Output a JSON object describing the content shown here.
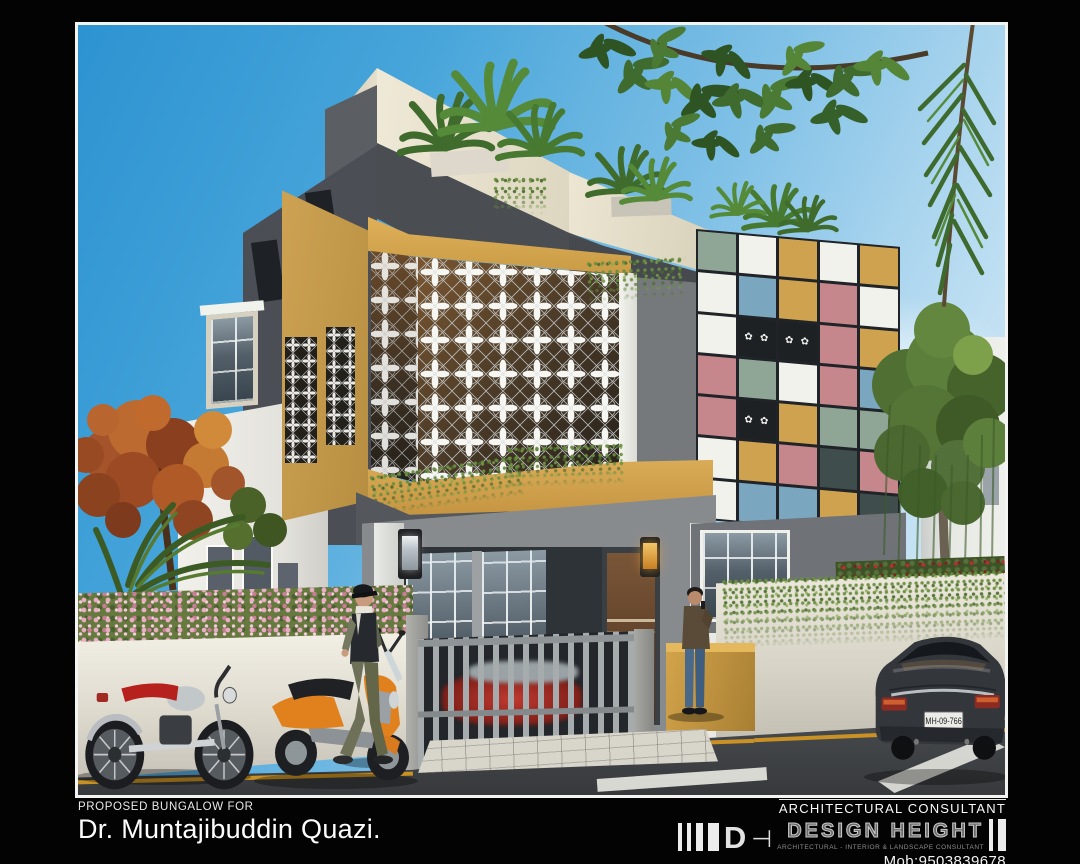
{
  "caption": {
    "project_label": "PROPOSED BUNGALOW FOR",
    "client_name": "Dr. Muntajibuddin Quazi.",
    "consultant_label": "ARCHITECTURAL CONSULTANT",
    "firm_monogram": "D",
    "firm_monogram_tail": "⊣",
    "firm_name": "DESIGN HEIGHT",
    "firm_subtitle": "ARCHITECTURAL - INTERIOR & LANDSCAPE CONSULTANT",
    "mobile": "Mob:9503839678"
  },
  "scene": {
    "vehicle_plate": "MH-09-766",
    "palette": {
      "sage": "#8fa697",
      "white": "#f2f2ed",
      "mustard": "#cfa24f",
      "blue": "#7ba6bf",
      "rose": "#c5868c",
      "teal": "#3f4e4d",
      "jali": "#1d2124",
      "sky_top": "#2d93d1",
      "sky_light": "#e6f2f9",
      "wall_dark_gray": "#4b4f55",
      "wall_mustard": "#c99d4c",
      "wall_cream": "#ece6d3",
      "compound_wall": "#ece8dd",
      "gate_gray": "#a6abae",
      "road": "#44474a",
      "hedge_pink": "#e8aec2",
      "foliage_green": "#4a7a33",
      "autumn_orange": "#b05a28",
      "scooter_orange": "#e0811e",
      "bike_seat_red": "#b6201d",
      "car_graphite": "#33363b",
      "lamp_amber": "#e8a13c"
    },
    "patchwork": {
      "columns": 5,
      "tiles": [
        {
          "c": "sage"
        },
        {
          "c": "white"
        },
        {
          "c": "mustard"
        },
        {
          "c": "white"
        },
        {
          "c": "mustard"
        },
        {
          "c": "white"
        },
        {
          "c": "blue"
        },
        {
          "c": "mustard"
        },
        {
          "c": "rose"
        },
        {
          "c": "white"
        },
        {
          "c": "white"
        },
        {
          "c": "jali",
          "jali": true
        },
        {
          "c": "jali",
          "jali": true
        },
        {
          "c": "rose"
        },
        {
          "c": "mustard"
        },
        {
          "c": "rose"
        },
        {
          "c": "sage"
        },
        {
          "c": "white"
        },
        {
          "c": "rose"
        },
        {
          "c": "blue"
        },
        {
          "c": "rose"
        },
        {
          "c": "jali",
          "jali": true
        },
        {
          "c": "mustard"
        },
        {
          "c": "sage"
        },
        {
          "c": "sage"
        },
        {
          "c": "white"
        },
        {
          "c": "mustard"
        },
        {
          "c": "rose"
        },
        {
          "c": "teal"
        },
        {
          "c": "rose"
        },
        {
          "c": "white"
        },
        {
          "c": "blue"
        },
        {
          "c": "blue"
        },
        {
          "c": "mustard"
        },
        {
          "c": "teal"
        }
      ]
    }
  }
}
